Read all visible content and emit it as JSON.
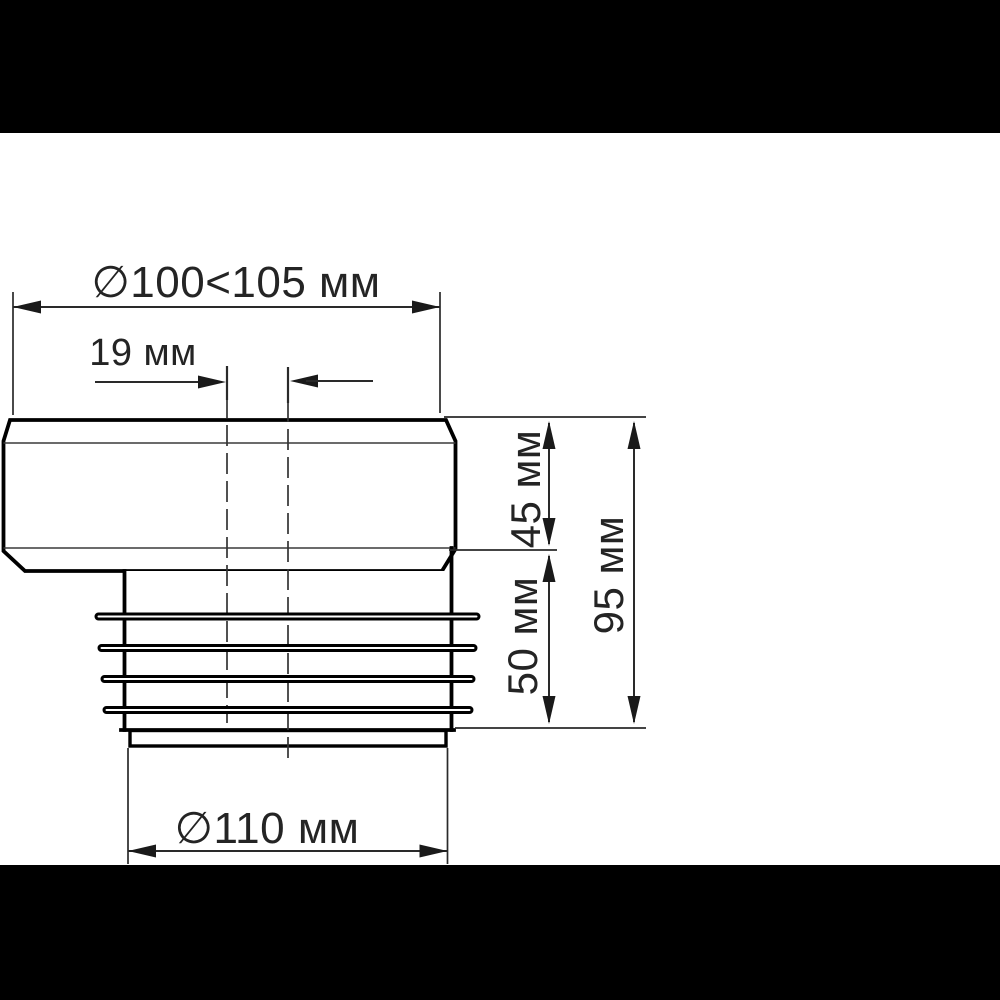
{
  "colors": {
    "background": "#ffffff",
    "letterbox": "#000000",
    "line": "#000000",
    "dimension_line": "#2a2a2a",
    "text": "#242424"
  },
  "dimensions": {
    "top_width": {
      "label": "∅100<105 мм",
      "min_mm": 100,
      "max_mm": 105
    },
    "offset": {
      "label": "19 мм",
      "value_mm": 19
    },
    "upper_height": {
      "label": "45 мм",
      "value_mm": 45
    },
    "lower_height": {
      "label": "50 мм",
      "value_mm": 50
    },
    "total_height": {
      "label": "95 мм",
      "value_mm": 95
    },
    "outlet_diameter": {
      "label": "∅110 мм",
      "value_mm": 110
    }
  }
}
